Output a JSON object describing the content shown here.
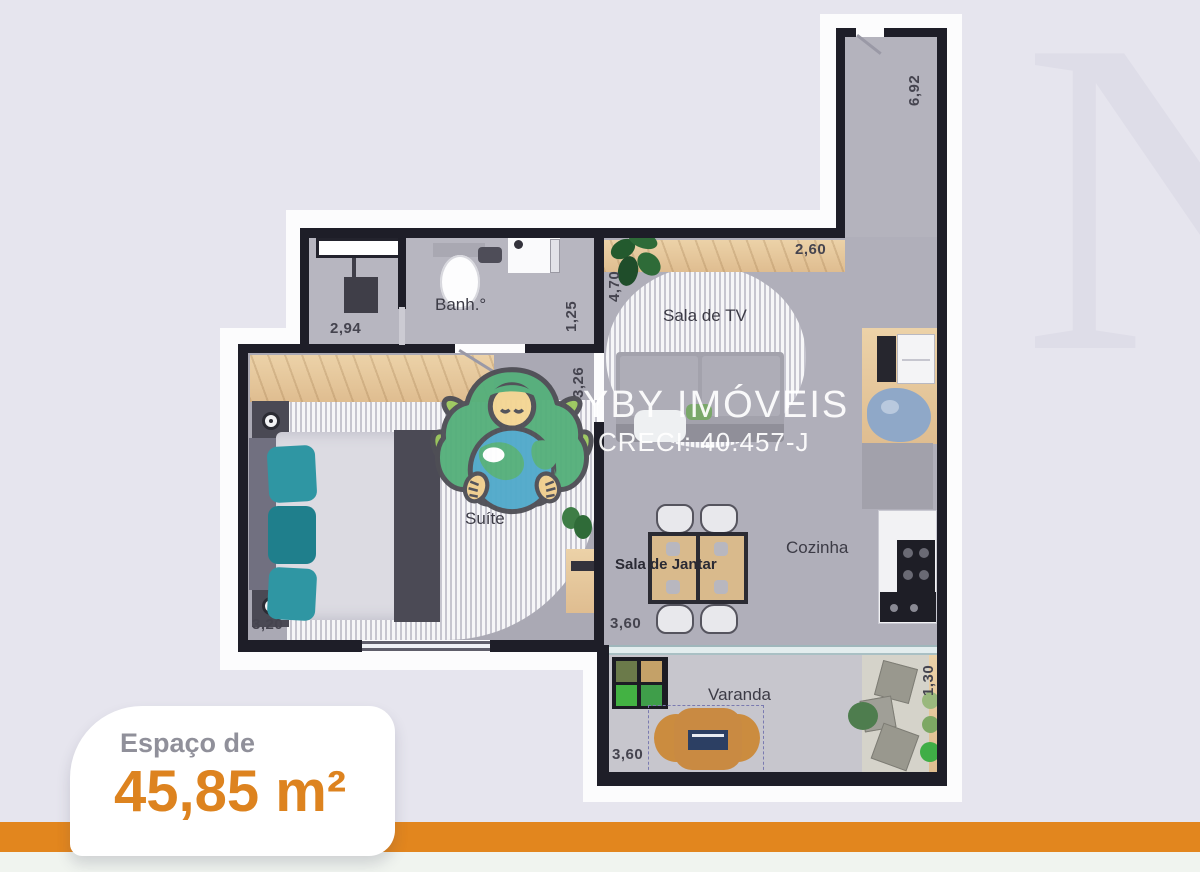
{
  "brand": {
    "name": "YBY IMÓVEIS",
    "creci": "CRECI: 40.457-J",
    "watermark_letter": "N"
  },
  "badge": {
    "prefix": "Espaço de",
    "area": "45,85 m²"
  },
  "rooms": {
    "banheiro": {
      "label": "Banh.°"
    },
    "sala_tv": {
      "label": "Sala de TV"
    },
    "suite": {
      "label": "Suíte"
    },
    "cozinha": {
      "label": "Cozinha"
    },
    "sala_jantar": {
      "label": "Sala de Jantar"
    },
    "varanda": {
      "label": "Varanda"
    }
  },
  "dimensions": {
    "entry_corridor": {
      "value": "6,92",
      "orientation": "vertical"
    },
    "sala_tv_width": {
      "value": "2,60",
      "orientation": "horizontal"
    },
    "sala_tv_depth": {
      "value": "4,70",
      "orientation": "vertical"
    },
    "laundry_width": {
      "value": "2,94",
      "orientation": "horizontal"
    },
    "bath_width": {
      "value": "1,25",
      "orientation": "vertical"
    },
    "hall_depth": {
      "value": "3,26",
      "orientation": "vertical"
    },
    "suite_width": {
      "value": "3,20",
      "orientation": "horizontal"
    },
    "dining_width": {
      "value": "3,60",
      "orientation": "horizontal"
    },
    "varanda_width": {
      "value": "3,60",
      "orientation": "horizontal"
    },
    "varanda_depth": {
      "value": "1,30",
      "orientation": "vertical"
    }
  },
  "colors": {
    "background": "#e6e5ee",
    "accent_orange": "#e2861e",
    "area_text_orange": "#dd831f",
    "wall": "#1e1e28",
    "teal_pillow": "#2f96a3"
  }
}
